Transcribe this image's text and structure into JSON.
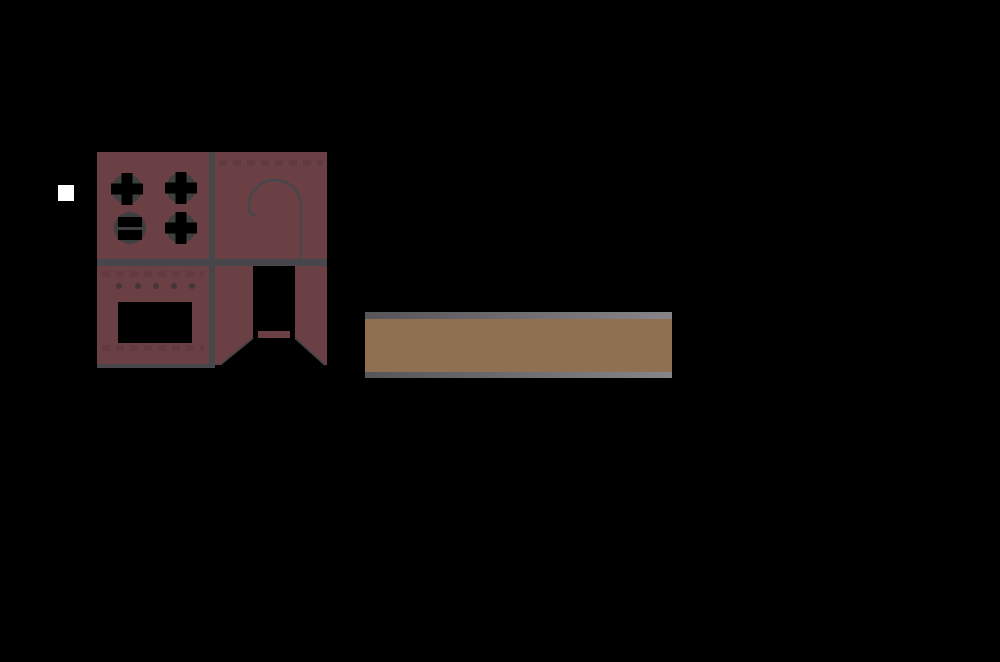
{
  "page": {
    "background_color": "#000000"
  },
  "marker": {
    "color": "#ffffff"
  },
  "logo": {
    "colors": {
      "body": "#6a4044",
      "outline": "#47474b",
      "burner_ring": "#3e3f3f",
      "cutout": "#000000",
      "knob": "#463539",
      "pattern": "#5c383c"
    }
  },
  "banner": {
    "colors": {
      "fill": "#8f7050",
      "edge_start": "#55555a",
      "edge_end": "#85858a"
    }
  }
}
